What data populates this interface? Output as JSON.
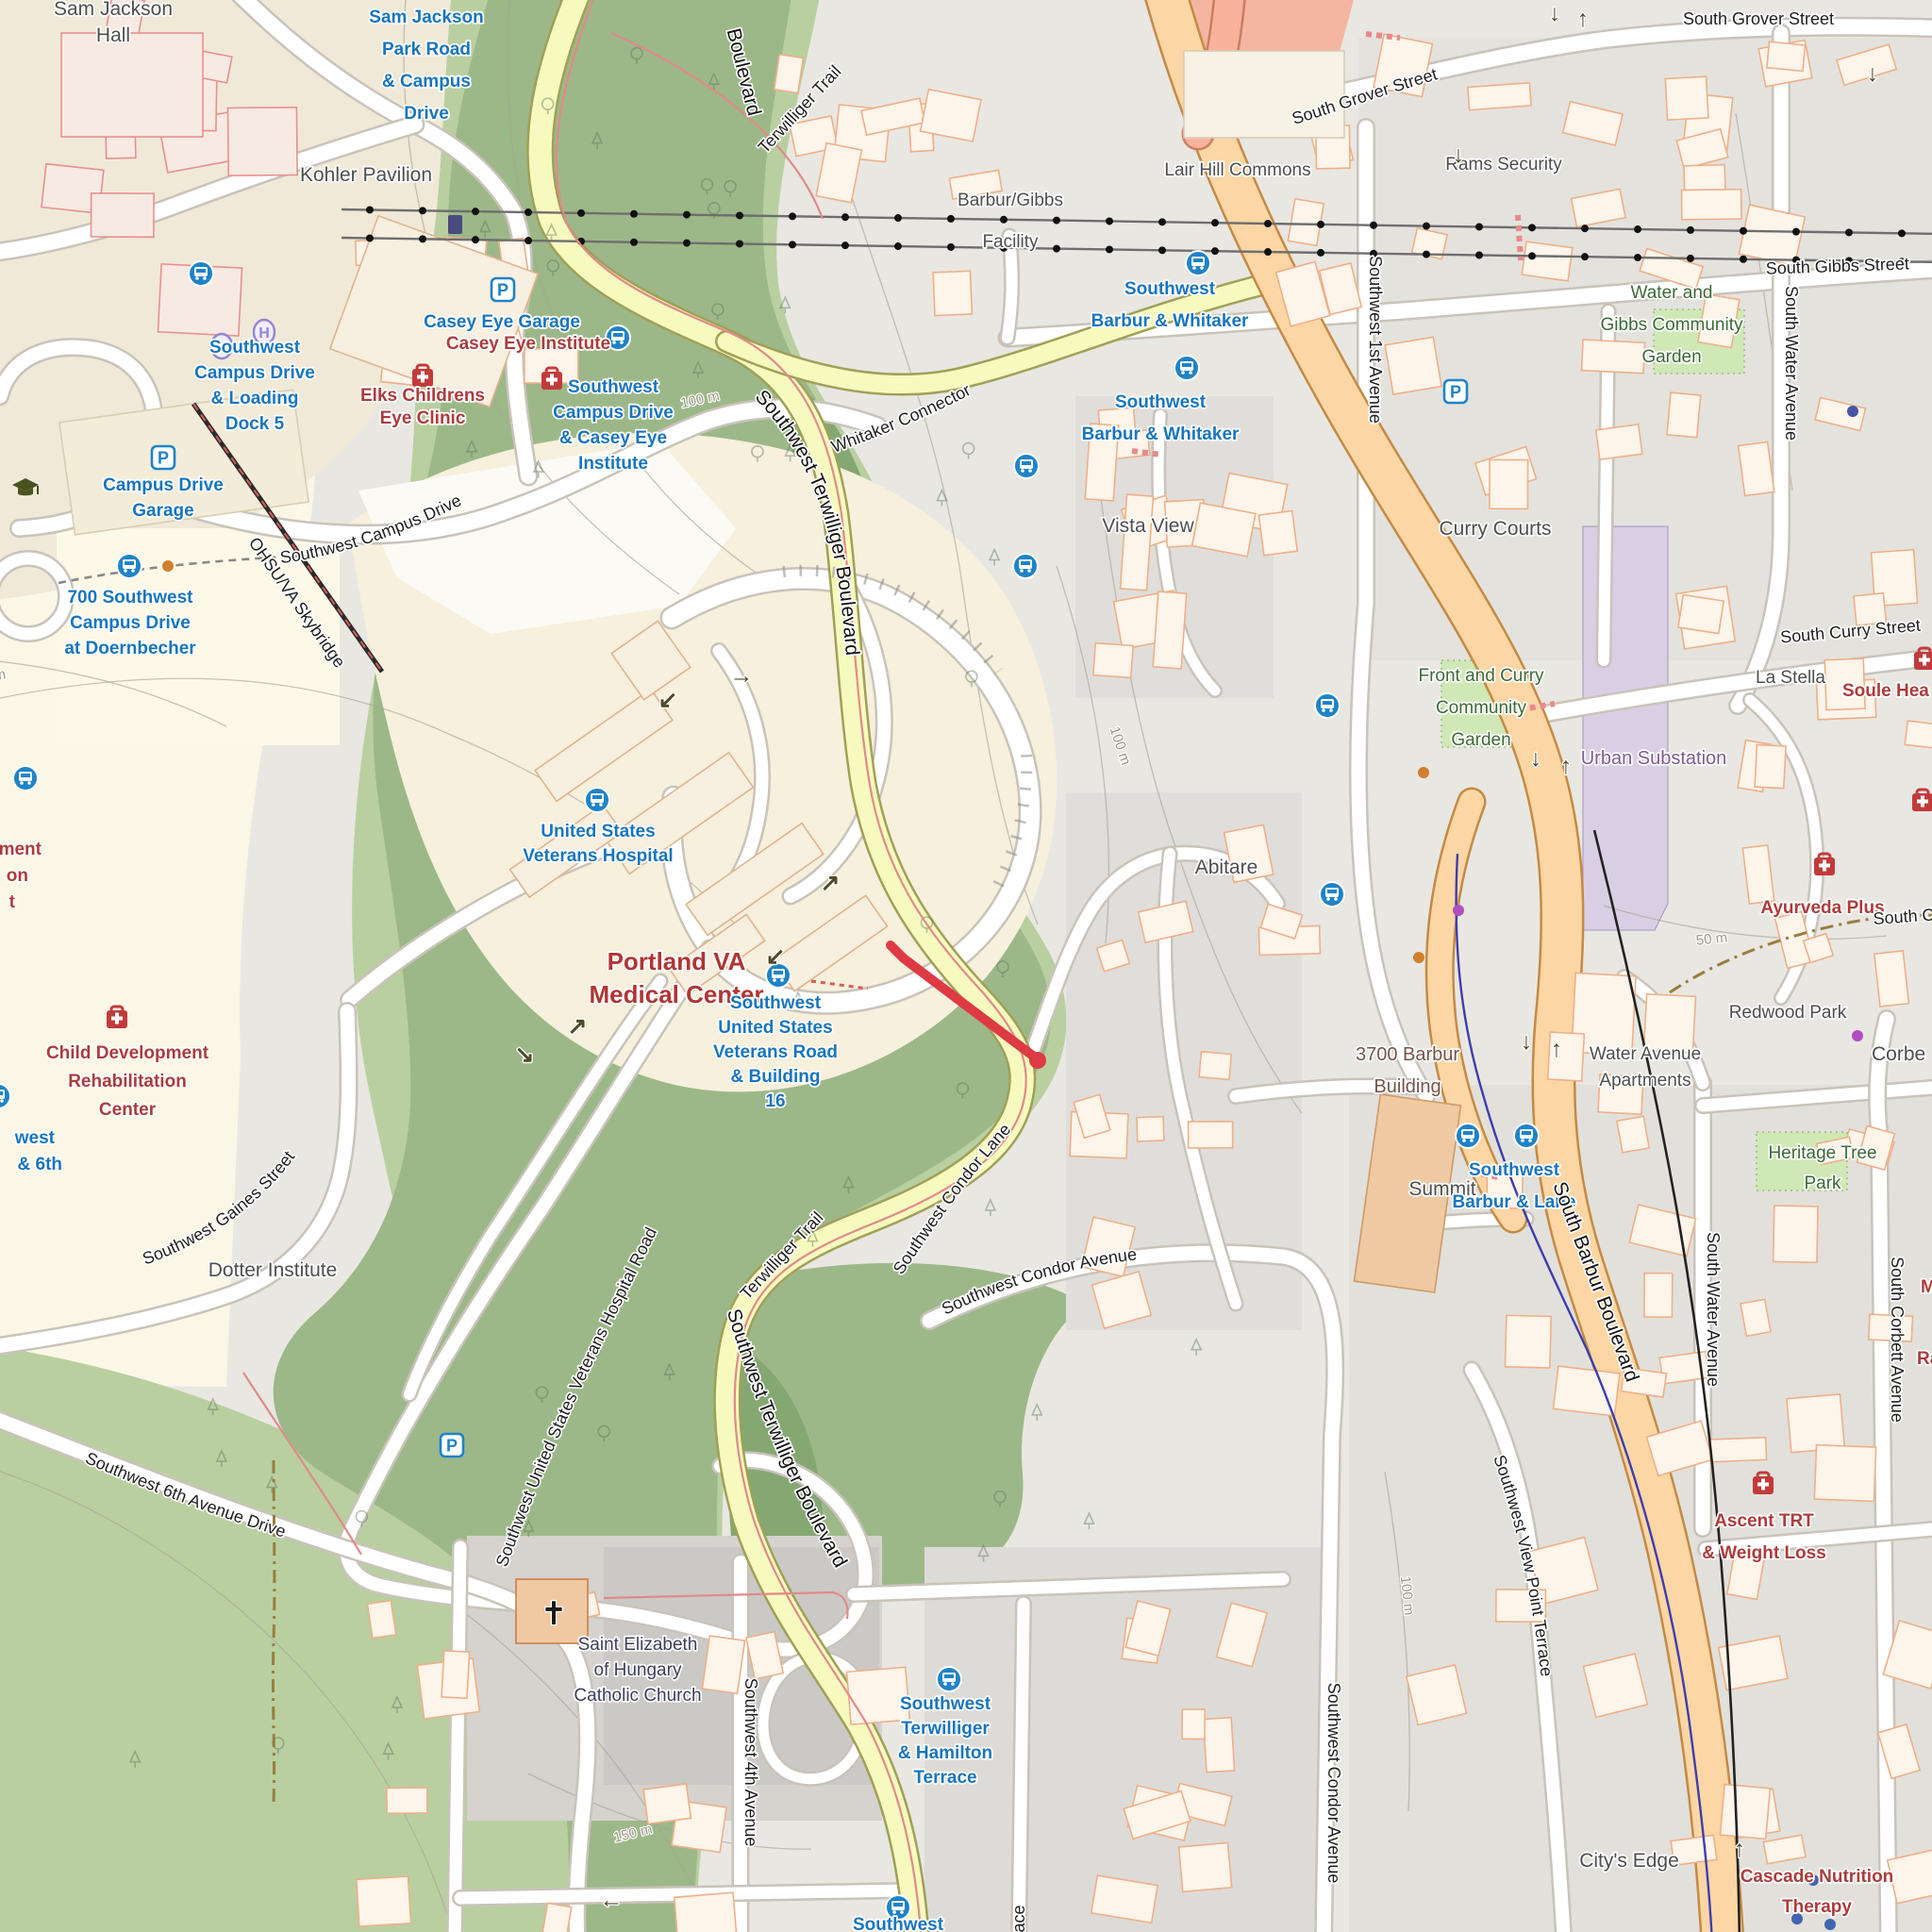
{
  "map_type": "openstreetmap-carto",
  "colors": {
    "transit_blue": "#1a75bc",
    "poi_red": "#ac3c3c",
    "route_highlight_red": "#de3a44",
    "primary_road_orange": "#fcd6a4",
    "secondary_road_yellow": "#f7fabe",
    "forest_green": "#9cb888",
    "garden_green": "#cfe8b5",
    "substation_purple": "#d9cfe4"
  },
  "places": {
    "sam_jackson_hall": [
      "Sam Jackson",
      "Hall"
    ],
    "kohler_pavilion": "Kohler Pavilion",
    "casey_eye_institute": "Casey Eye Institute",
    "elks_childrens": [
      "Elks Childrens",
      "Eye Clinic"
    ],
    "portland_va": [
      "Portland VA",
      "Medical Center"
    ],
    "child_dev": [
      "Child Development",
      "Rehabilitation",
      "Center"
    ],
    "dotter_institute": "Dotter Institute",
    "barbur_gibbs_facility": [
      "Barbur/Gibbs",
      "Facility"
    ],
    "lair_hill_commons": "Lair Hill Commons",
    "rams_security": "Rams Security",
    "water_gibbs_garden": [
      "Water and",
      "Gibbs Community",
      "Garden"
    ],
    "curry_courts": "Curry Courts",
    "front_curry_garden": [
      "Front and Curry",
      "Community",
      "Garden"
    ],
    "urban_substation": "Urban Substation",
    "la_stella": "La Stella",
    "soule_partial": "Soule Hea",
    "corbett_partial": "Corbe",
    "ayurveda_plus": "Ayurveda Plus",
    "redwood_park": "Redwood Park",
    "heritage_tree_park": [
      "Heritage Tree",
      "Park"
    ],
    "water_ave_apartments": [
      "Water Avenue",
      "Apartments"
    ],
    "vista_view": "Vista View",
    "abitare": "Abitare",
    "barbur_3700": [
      "3700 Barbur",
      "Building"
    ],
    "summit": "Summit",
    "ascent_trt": [
      "Ascent TRT",
      "& Weight Loss"
    ],
    "cascade_nutrition": [
      "Cascade Nutrition",
      "Therapy"
    ],
    "citys_edge": "City's Edge",
    "saint_elizabeth": [
      "Saint Elizabeth",
      "of Hungary",
      "Catholic Church"
    ],
    "ment_partial": [
      "ment",
      "on",
      "t"
    ],
    "m_partial": "M",
    "ra_partial": "Ra"
  },
  "transit_stops": {
    "sam_jackson_park": [
      "Sam Jackson",
      "Park Road",
      "& Campus",
      "Drive"
    ],
    "casey_eye_garage": "Casey Eye Garage",
    "campus_drive_garage": [
      "Campus Drive",
      "Garage"
    ],
    "sw_campus_loading": [
      "Southwest",
      "Campus Drive",
      "& Loading",
      "Dock 5"
    ],
    "sw_campus_casey": [
      "Southwest",
      "Campus Drive",
      "& Casey Eye",
      "Institute"
    ],
    "campus_700": [
      "700 Southwest",
      "Campus Drive",
      "at Doernbecher"
    ],
    "us_veterans_hospital": [
      "United States",
      "Veterans Hospital"
    ],
    "sw_veterans_rd_16": [
      "Southwest",
      "United States",
      "Veterans Road",
      "& Building",
      "16"
    ],
    "barbur_whitaker": [
      "Southwest",
      "Barbur & Whitaker"
    ],
    "barbur_lane": [
      "Southwest",
      "Barbur & Lane"
    ],
    "terwilliger_hamilton": [
      "Southwest",
      "Terwilliger",
      "& Hamilton",
      "Terrace"
    ],
    "bottom_partial": "Southwest",
    "west_6th_partial": [
      "west",
      "& 6th"
    ]
  },
  "streets": {
    "south_grover": "South Grover Street",
    "south_gibbs": "South Gibbs Street",
    "sw_1st_ave": "Southwest 1st Avenue",
    "south_water_ave": "South Water Avenue",
    "south_curry": "South Curry Street",
    "south_corbett_ave": "South Corbett Avenue",
    "south_c_partial": "South C",
    "sw_condor_ave": "Southwest Condor Avenue",
    "sw_condor_lane": "Southwest Condor Lane",
    "sw_view_point": "Southwest View Point Terrace",
    "south_barbur_blvd": "South Barbur Boulevard",
    "sw_terwilliger_blvd": "Southwest Terwilliger Boulevard",
    "boulevard_partial": "Boulevard",
    "terwilliger_trail": "Terwilliger Trail",
    "whitaker_connector": "Whitaker Connector",
    "sw_campus_drive": "Southwest Campus Drive",
    "sw_gaines": "Southwest Gaines Street",
    "sw_vets_hospital_rd": "Southwest United States Veterans Hospital Road",
    "sw_6th_ave_drive": "Southwest 6th Avenue Drive",
    "sw_4th_ave": "Southwest 4th Avenue",
    "ohsu_va_skybridge": "OHSU/VA Skybridge",
    "terrace_partial": "ace"
  },
  "contours": {
    "c100": "100 m",
    "c50": "50 m",
    "c150": "150 m"
  },
  "icons": {
    "bus_stop": "bus-stop-icon",
    "parking": "parking-icon",
    "helipad": "helipad-icon",
    "medical": "medical-icon",
    "education": "graduation-cap-icon",
    "church": "christian-cross-icon",
    "tram_station": "aerial-tram-station-icon"
  }
}
